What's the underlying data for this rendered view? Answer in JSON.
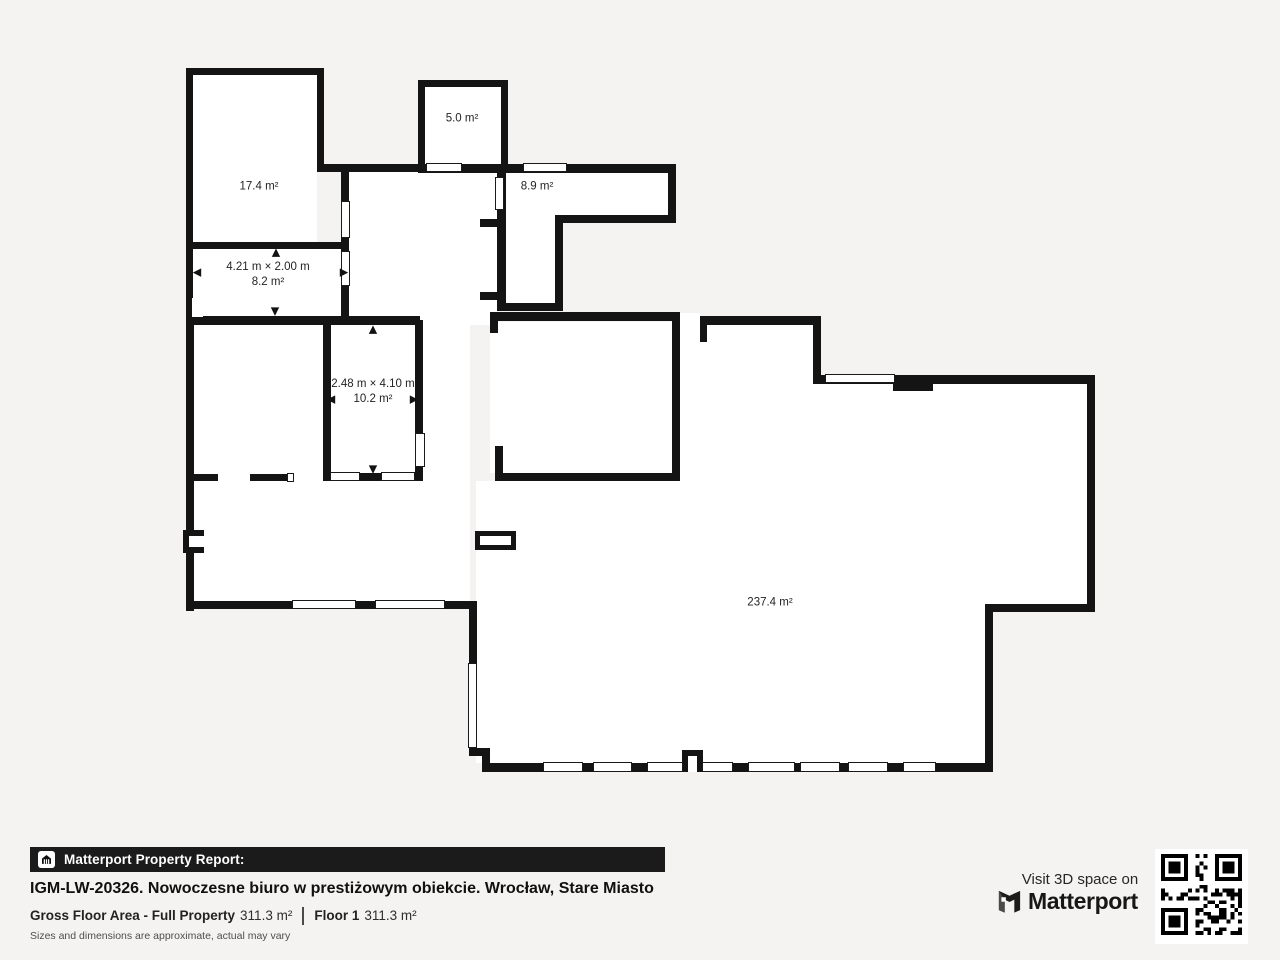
{
  "colors": {
    "background": "#f4f3f1",
    "wall": "#141414",
    "room_fill": "#ffffff",
    "footer_bar": "#1b1b1b",
    "text": "#111111",
    "muted": "#4d4d4d"
  },
  "floorplan": {
    "interiors": [
      [
        193,
        75,
        124,
        167
      ],
      [
        193,
        249,
        148,
        67
      ],
      [
        348,
        172,
        149,
        144
      ],
      [
        425,
        87,
        76,
        77
      ],
      [
        504,
        173,
        164,
        44
      ],
      [
        504,
        173,
        52,
        130
      ],
      [
        490,
        322,
        186,
        151
      ],
      [
        194,
        325,
        276,
        276
      ],
      [
        680,
        322,
        133,
        441
      ],
      [
        813,
        384,
        274,
        220
      ],
      [
        813,
        604,
        172,
        159
      ],
      [
        476,
        481,
        204,
        282
      ],
      [
        420,
        314,
        70,
        11
      ],
      [
        680,
        313,
        20,
        9
      ]
    ],
    "walls": [
      [
        186,
        68,
        138,
        7
      ],
      [
        186,
        68,
        7,
        255
      ],
      [
        317,
        68,
        7,
        103
      ],
      [
        317,
        164,
        108,
        8
      ],
      [
        186,
        242,
        162,
        7
      ],
      [
        341,
        164,
        8,
        160
      ],
      [
        186,
        316,
        234,
        9
      ],
      [
        418,
        80,
        7,
        91
      ],
      [
        418,
        80,
        90,
        7
      ],
      [
        501,
        80,
        7,
        91
      ],
      [
        418,
        164,
        90,
        9
      ],
      [
        508,
        164,
        168,
        9
      ],
      [
        668,
        164,
        8,
        59
      ],
      [
        556,
        215,
        120,
        8
      ],
      [
        555,
        215,
        8,
        96
      ],
      [
        497,
        171,
        9,
        140
      ],
      [
        480,
        219,
        18,
        8
      ],
      [
        480,
        292,
        18,
        8
      ],
      [
        497,
        303,
        66,
        8
      ],
      [
        490,
        312,
        190,
        9
      ],
      [
        490,
        312,
        8,
        21
      ],
      [
        495,
        446,
        8,
        35
      ],
      [
        495,
        473,
        185,
        8
      ],
      [
        672,
        313,
        8,
        168
      ],
      [
        700,
        316,
        7,
        26
      ],
      [
        700,
        316,
        121,
        9
      ],
      [
        813,
        316,
        8,
        68
      ],
      [
        813,
        375,
        282,
        9
      ],
      [
        893,
        384,
        40,
        7
      ],
      [
        1087,
        375,
        8,
        237
      ],
      [
        985,
        604,
        110,
        8
      ],
      [
        985,
        604,
        8,
        168
      ],
      [
        482,
        763,
        511,
        9
      ],
      [
        469,
        604,
        8,
        152
      ],
      [
        469,
        748,
        21,
        8
      ],
      [
        482,
        748,
        8,
        24
      ],
      [
        186,
        316,
        8,
        295
      ],
      [
        186,
        601,
        291,
        8
      ],
      [
        323,
        320,
        8,
        161
      ],
      [
        415,
        320,
        8,
        161
      ],
      [
        323,
        473,
        100,
        8
      ],
      [
        193,
        474,
        25,
        7
      ],
      [
        250,
        474,
        37,
        7
      ],
      [
        183,
        530,
        21,
        23
      ],
      [
        682,
        750,
        21,
        22
      ]
    ],
    "boxes": [
      [
        475,
        531,
        41,
        19
      ]
    ],
    "white_patches": [
      [
        192,
        298,
        11,
        19
      ],
      [
        189,
        536,
        16,
        11
      ],
      [
        688,
        756,
        9,
        16
      ]
    ],
    "windows": [
      [
        426,
        163,
        36,
        9
      ],
      [
        523,
        163,
        44,
        9
      ],
      [
        341,
        201,
        9,
        37
      ],
      [
        341,
        251,
        9,
        35
      ],
      [
        495,
        177,
        9,
        33
      ],
      [
        415,
        433,
        10,
        34
      ],
      [
        330,
        472,
        30,
        9
      ],
      [
        381,
        472,
        34,
        9
      ],
      [
        292,
        600,
        64,
        9
      ],
      [
        375,
        600,
        70,
        9
      ],
      [
        468,
        663,
        9,
        85
      ],
      [
        825,
        374,
        70,
        9
      ],
      [
        287,
        473,
        7,
        9
      ],
      [
        543,
        762,
        40,
        10
      ],
      [
        593,
        762,
        39,
        10
      ],
      [
        647,
        762,
        36,
        10
      ],
      [
        702,
        762,
        31,
        10
      ],
      [
        748,
        762,
        47,
        10
      ],
      [
        800,
        762,
        40,
        10
      ],
      [
        848,
        762,
        40,
        10
      ],
      [
        903,
        762,
        33,
        10
      ]
    ],
    "arrows": [
      {
        "x": 276,
        "y": 252,
        "dir": "up"
      },
      {
        "x": 275,
        "y": 311,
        "dir": "down"
      },
      {
        "x": 197,
        "y": 272,
        "dir": "left"
      },
      {
        "x": 344,
        "y": 272,
        "dir": "right"
      },
      {
        "x": 373,
        "y": 329,
        "dir": "up"
      },
      {
        "x": 331,
        "y": 399,
        "dir": "left"
      },
      {
        "x": 414,
        "y": 399,
        "dir": "right"
      },
      {
        "x": 373,
        "y": 469,
        "dir": "down"
      }
    ],
    "labels": [
      {
        "x": 259,
        "y": 187,
        "lines": [
          "17.4 m²"
        ]
      },
      {
        "x": 462,
        "y": 119,
        "lines": [
          "5.0 m²"
        ]
      },
      {
        "x": 537,
        "y": 187,
        "lines": [
          "8.9 m²"
        ]
      },
      {
        "x": 268,
        "y": 275,
        "lines": [
          "4.21 m × 2.00 m",
          "8.2 m²"
        ]
      },
      {
        "x": 373,
        "y": 392,
        "lines": [
          "2.48 m × 4.10 m",
          "10.2 m²"
        ]
      },
      {
        "x": 770,
        "y": 603,
        "lines": [
          "237.4 m²"
        ]
      }
    ]
  },
  "footer": {
    "bar_label": "Matterport Property Report:",
    "title": "IGM-LW-20326. Nowoczesne biuro w prestiżowym obiekcie. Wrocław, Stare Miasto",
    "gross_label": "Gross Floor Area - Full Property",
    "gross_value": "311.3 m²",
    "floor_label": "Floor 1",
    "floor_value": "311.3 m²",
    "disclaimer": "Sizes and dimensions are approximate, actual may vary",
    "visit_text": "Visit 3D space on",
    "brand": "Matterport"
  }
}
